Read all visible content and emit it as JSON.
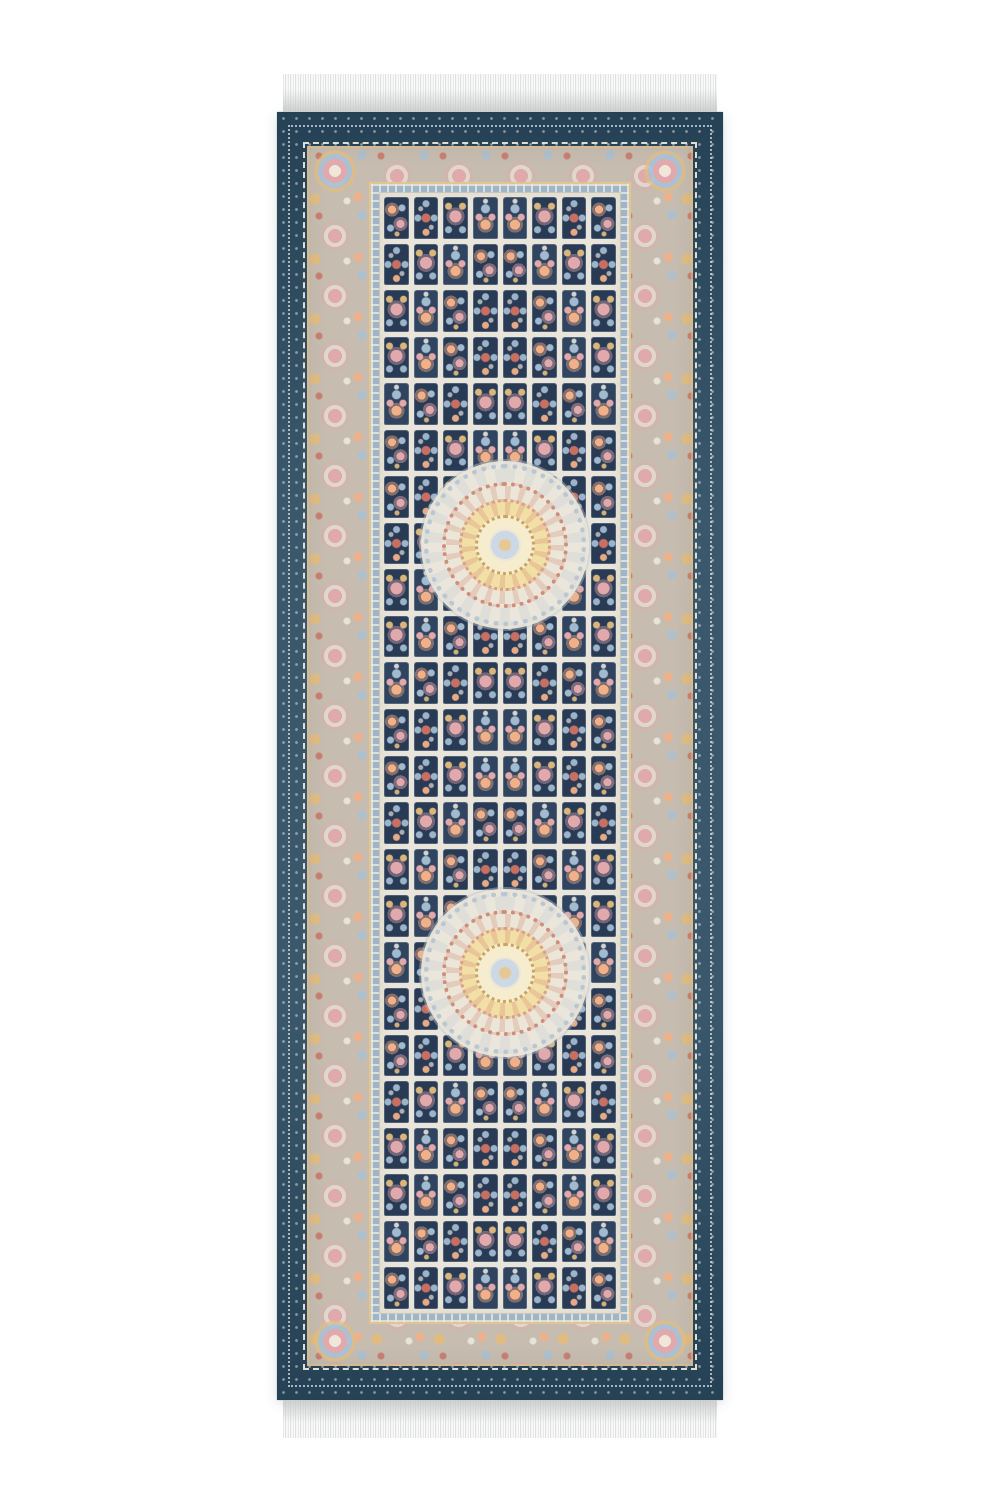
{
  "meta": {
    "description": "Product photo of an ornate Persian-style runner rug on a white background: navy-blue outer border with white vine scrollwork, wide beige floral main border with pink roses and gold accents, light-blue guard band, cream field divided into a grid of small dark navy flower panels, two round cream rosette medallions on the vertical axis, and white fringe tassels at top and bottom.",
    "image_width_px": 1000,
    "image_height_px": 1500
  },
  "palette": {
    "background": "#ffffff",
    "navy_border": "#2f4e63",
    "navy_deep": "#203a50",
    "panel_navy": "#293a54",
    "beige_border": "#c6bcb0",
    "cream": "#eae5da",
    "guard_blue": "#9fb5c9",
    "gold": "#e3bd7d",
    "pink": "#e2a9ad",
    "peach": "#f2b088",
    "salmon": "#c96f62",
    "pale_blue": "#a8c1d6",
    "yellow_ring": "#f2dfa6",
    "fringe_light": "#f7f8f7",
    "fringe_shade": "#c4c8c7"
  },
  "rug": {
    "bounds": {
      "left": 277,
      "top": 112,
      "width": 446,
      "height": 1288
    },
    "fringe": {
      "height": 38,
      "side_inset": 6,
      "positions": [
        "top",
        "bottom"
      ]
    },
    "borders": {
      "outer_navy_px": {
        "sides": 30,
        "top": 34,
        "bottom": 34
      },
      "main_floral_px": {
        "sides": 62,
        "top": 36,
        "bottom": 42
      },
      "guard_band_px": 11
    },
    "field": {
      "rows": 24,
      "cols": 8,
      "panel_motif_variants": 4
    },
    "medallions": [
      {
        "cx": 223,
        "cy": 428,
        "d": 152
      },
      {
        "cx": 223,
        "cy": 856,
        "d": 152
      }
    ]
  }
}
